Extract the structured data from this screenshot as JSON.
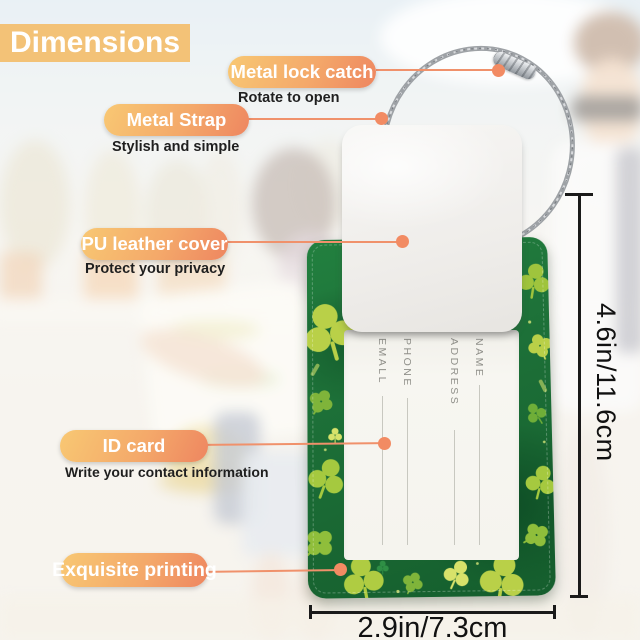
{
  "title": "Dimensions",
  "callouts": [
    {
      "label": "Metal lock catch",
      "sub": "Rotate to open"
    },
    {
      "label": "Metal Strap",
      "sub": "Stylish and simple"
    },
    {
      "label": "PU leather cover",
      "sub": "Protect your privacy"
    },
    {
      "label": "ID card",
      "sub": "Write your contact information"
    },
    {
      "label": "Exquisite printing",
      "sub": ""
    }
  ],
  "dimensions": {
    "height_label": "4.6in/11.6cm",
    "width_label": "2.9in/7.3cm"
  },
  "card": {
    "fields": [
      "NAME",
      "ADDRESS",
      "PHONE",
      "EMALL"
    ]
  },
  "colors": {
    "accent": "#F08A5E",
    "pill_light": "#F8C873",
    "tag_green": "#1D7038",
    "card_white": "#F6F5F0",
    "title_badge": "#F3C277"
  }
}
